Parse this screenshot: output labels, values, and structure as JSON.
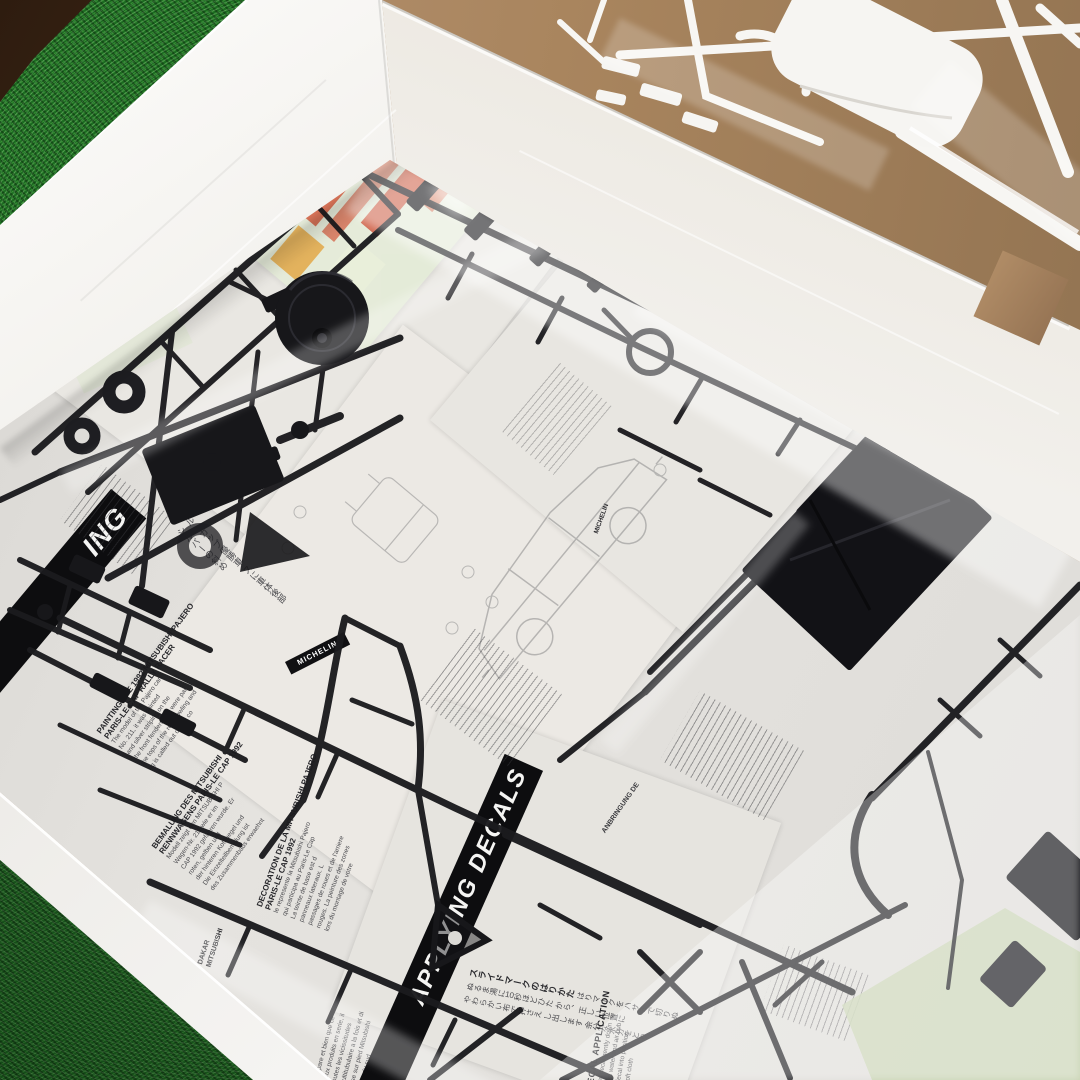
{
  "scene": {
    "description": "Opened model kit box on artificial grass: black plastic sprues in a clear bag over folded multilingual instruction sheets; white body sprues on tan table behind the box wall",
    "colors": {
      "grass_green": "#1c6b21",
      "grass_dark": "#14521a",
      "wood_brown": "#42291a",
      "box_white": "#f1efeb",
      "wall_shade": "#d9d6d0",
      "table_tan": "#ad8a64",
      "paper_white": "#e9e7e2",
      "sprue_black": "#1a1a1d",
      "sprue_white": "#f6f5f2",
      "decal_mint": "#e4ecd8",
      "decal_orange": "#d4694b",
      "decal_yellow": "#e2ae52",
      "bag_sheen": "#ffffff"
    }
  },
  "sheets": {
    "painting_en": {
      "header_fragment": "ING",
      "title1": "PAINTING THE 1992 MITSUBISHI PAJERO",
      "title2": "PARIS-LE CAP RALLY RACER",
      "body_lines": [
        "The model of the Pajero car",
        "No. 211, it was painted",
        "and silver striping on the",
        "the front fenders and were pai",
        "the tops of the rear cowling and",
        "ng is called out during co"
      ]
    },
    "painting_de": {
      "title1": "BEMALUNG DES MITSUBISHI",
      "title2": "RENNWAGENS PARIS-LE CAP 1992",
      "body_lines": [
        "Modell zeigt den MITSUBISHI P",
        "Wagen-Nr. 211 wie er im",
        "CAP 1992 gefahren wurde. Er",
        "roten, gelben und",
        "der hinteren Kotfluegel und",
        "Die Einzelteilbemalung ist",
        "des Zusammenbaus erwaehnt"
      ]
    },
    "painting_fr": {
      "title1": "DECORATION DE LA MITSUBISHI PAJERO",
      "title2": "PARIS-LE CAP 1992",
      "body_lines": [
        "le represente la Mitsubishi Pajero",
        "qui participa au Paris-Le Cap",
        "La teinte de base est d",
        "panneaux lateraux. L",
        "passages de roues et de l'arriere",
        "rouges. La peinture des zones",
        "lors du montage de votre"
      ]
    },
    "fr_lower": {
      "body_lines": [
        "prepare et bien que ce",
        "ceux produits en serie, il",
        "toutes les vicissitudes",
        "multitubulaire a la fois et di",
        "base sur pied Mitsubishi",
        "rayee du sud"
      ]
    },
    "decals": {
      "bar_label": "APPLYING DECALS",
      "heading_en": "DECAL APPLICATION",
      "heading_jp": "スライドマークのはりかた",
      "de_fragment": "ANBRINGUNG DE",
      "en_lines": [
        "Press decal gently down",
        "excess water and air bub",
        "ove decal into position",
        "with soft cloth"
      ],
      "jp_columns": [
        "はりマークをハサミで切りぬ",
        "ぬるま湯に10秒ほどひた",
        "から、正しい位置に",
        "やわらかい布で押さえ",
        "し出します",
        "余分な水分をとり"
      ]
    },
    "jp_side_columns": [
      "ル・カップ優勝車",
      "スに車体後部",
      "シルバーの斜め"
    ],
    "labels": {
      "michelin": "MICHELIN",
      "dakar": "DAKAR",
      "mitsubishi": "MITSUBISHI",
      "decoration_fragment": "DECORATION",
      "paris_le": "PARIS-LE"
    }
  }
}
